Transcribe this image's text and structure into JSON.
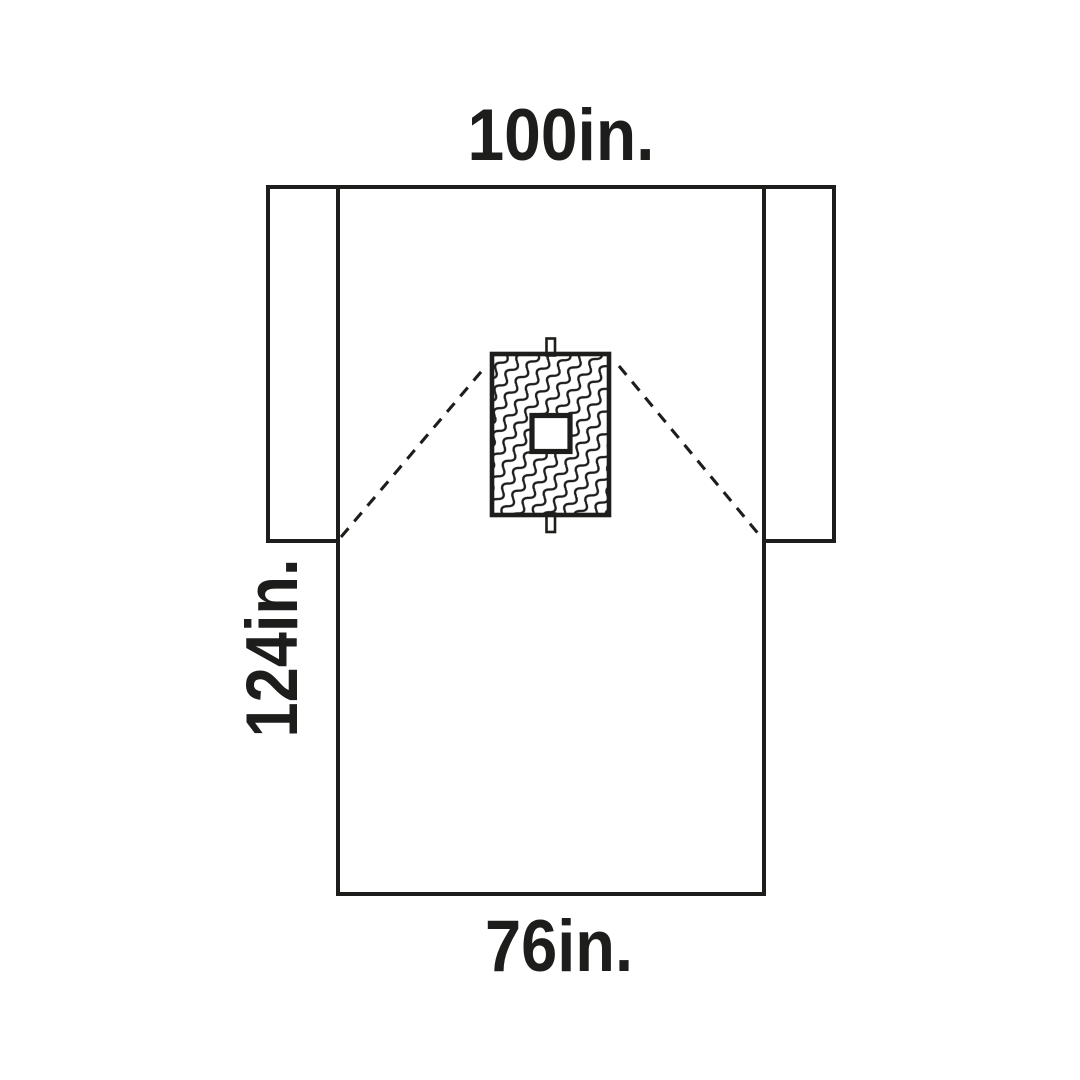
{
  "diagram": {
    "labels": {
      "top_width": "100in.",
      "side_length": "124in.",
      "bottom_width": "76in."
    },
    "colors": {
      "line": "#1d1d1b",
      "background": "#ffffff"
    }
  }
}
